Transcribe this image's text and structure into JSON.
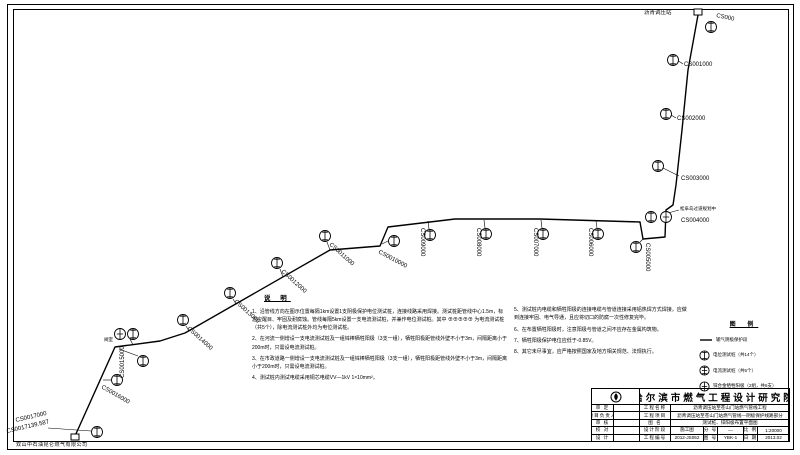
{
  "station": {
    "label": "沥青调压站"
  },
  "footer": {
    "company": "双山中石油昆仑燃气有限公司"
  },
  "valve": {
    "label": "阀室"
  },
  "crossing": {
    "label": "松阜岛过道规划中"
  },
  "markers": [
    {
      "label": "CS000"
    },
    {
      "label": "CS001000"
    },
    {
      "label": "CS002000"
    },
    {
      "label": "CS003000"
    },
    {
      "label": "CS004000"
    },
    {
      "label": "CS005000"
    },
    {
      "label": "CS006000"
    },
    {
      "label": "CS007000"
    },
    {
      "label": "CS008000"
    },
    {
      "label": "CS009000"
    },
    {
      "label": "CS0010000"
    },
    {
      "label": "CS0011000"
    },
    {
      "label": "CS0012000"
    },
    {
      "label": "CS0013000"
    },
    {
      "label": "CS0014000"
    },
    {
      "label": "CS0015000"
    },
    {
      "label": "CS0016000"
    },
    {
      "label": "CS0017000"
    },
    {
      "label": "CS0017139.587"
    }
  ],
  "notes": {
    "heading": "说 明",
    "left": [
      "1、沿管线方向在图示位置每隔1km设置1支阴极保护电位测试桩，连接线路采用焊接。测试桩距管线中心1.5m，标志应醒目、牢固及耐腐蚀。管线每隔5km设置一支电流测试桩，并兼作电位测试桩。其中 ⊕⊕⊕⊕⊕ 为电流测试桩（共5个），除电流测试桩外均为电位测试桩。",
      "2、在河流一侧增设一支电流测试桩及一组锌棒牺牲阳极（3支一组），牺牲阳极距管线外壁不小于3m，间隔距离小于200m时，只需设电流测试桩。",
      "3、在市政道路一侧增设一支电流测试桩及一组锌棒牺牲阳极（3支一组），牺牲阳极距管线外壁不小于3m，间隔距离小于200m时，只需设电流测试桩。",
      "4、测试桩内测试电缆采用铜芯电缆VV—1kV 1×10mm²。"
    ],
    "right": [
      "5、测试桩内电缆和牺牲阳极的连接电缆与管道连接采用铝热焊方式焊接，应做到连接牢固、电气导通，且应将切口的防腐一次性修复完毕。",
      "6、在布置牺牲阳极时，注意阳极与管道之间不应存在金属构筑物。",
      "7、牺牲阳极保护电位应低于-0.85V。",
      "8、其它未尽事宜，应严格按照国家及地方相关规范、法规执行。"
    ]
  },
  "legend": {
    "title": "图 例",
    "items": [
      {
        "label": "输气阴极保护段"
      },
      {
        "label": "电位测试桩（共14个）"
      },
      {
        "label": "电流测试桩（共5个）"
      },
      {
        "label": "锌合金牺牲阳极（2组，共6支）"
      }
    ]
  },
  "titleblock": {
    "institute": "哈尔滨市燃气工程设计研究院",
    "rows": [
      {
        "label": "审  定",
        "field": "工程名称",
        "value": "沥青调压站至苍山门站燃气管线工程"
      },
      {
        "label": "项目负责人",
        "field": "工程项目",
        "value": "沥青调压站至苍山门站燃气管线—阴极保护线路部分"
      },
      {
        "label": "审  核",
        "field": "图  名",
        "value": "测试桩、锌阳极布置平面图"
      },
      {
        "label": "校  对",
        "field": "设计阶段",
        "value": "施工图",
        "field2": "分  号",
        "value2": "—",
        "field3": "比  例",
        "value3": "1:20000"
      },
      {
        "label": "设  计",
        "field": "工程编号",
        "value": "2012-JS052",
        "field2": "图  号",
        "value2": "YBK-1",
        "field3": "日  期",
        "value3": "2013.02"
      }
    ]
  }
}
